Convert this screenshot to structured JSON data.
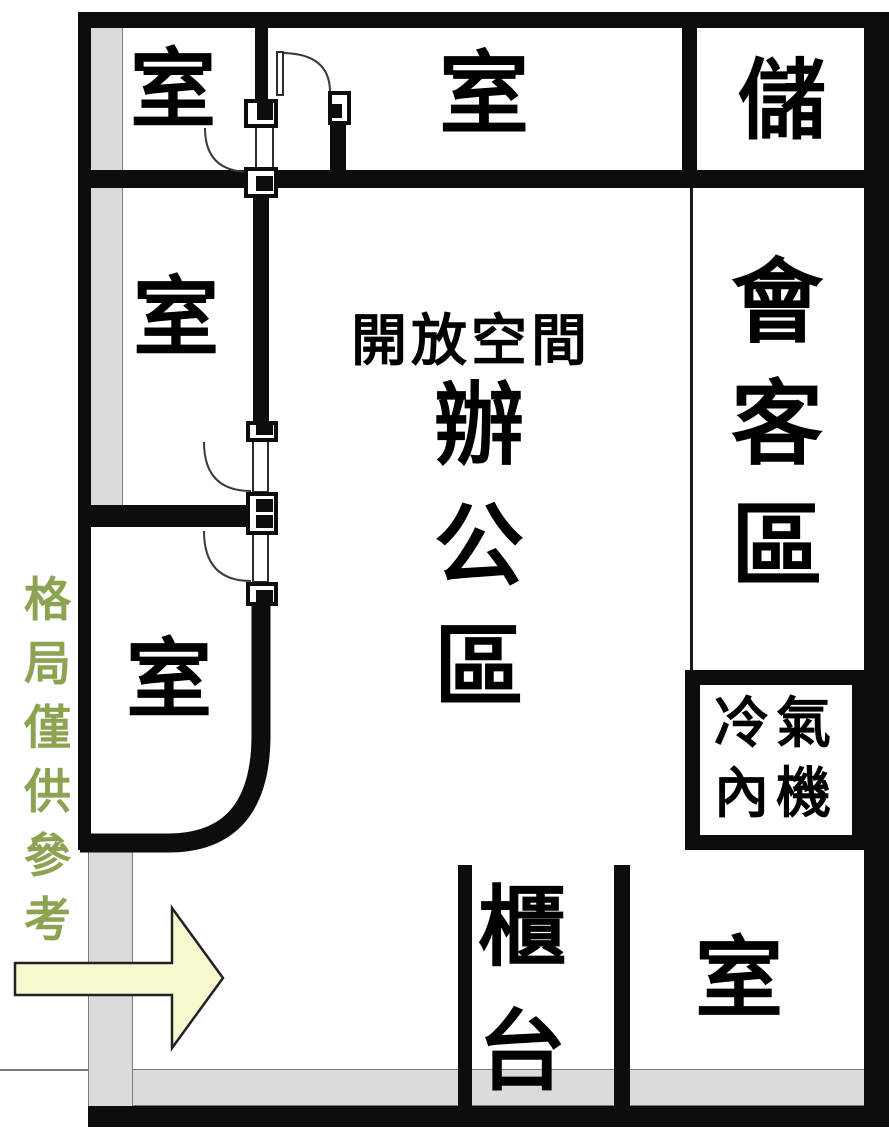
{
  "floor_plan": {
    "rooms": {
      "top_left_label": "室",
      "top_middle_label": "室",
      "storage_label": "儲",
      "mid_left_label": "室",
      "lower_left_label": "室",
      "bottom_right_label": "室"
    },
    "open_office": {
      "title": "開放空間",
      "subtitle_chars": [
        "辦",
        "公",
        "區"
      ]
    },
    "reception_chars": [
      "會",
      "客",
      "區"
    ],
    "ac_unit_lines": [
      "冷氣",
      "內機"
    ],
    "counter_chars": [
      "櫃",
      "台"
    ],
    "watermark_chars": [
      "格",
      "局",
      "僅",
      "供",
      "參",
      "考"
    ],
    "colors": {
      "wall": "#0d0d0d",
      "strip_gray": "#dbdbdb",
      "watermark_green": "#8ca352",
      "arrow_fill": "#f7f7d0",
      "arrow_outline": "#222222"
    }
  }
}
